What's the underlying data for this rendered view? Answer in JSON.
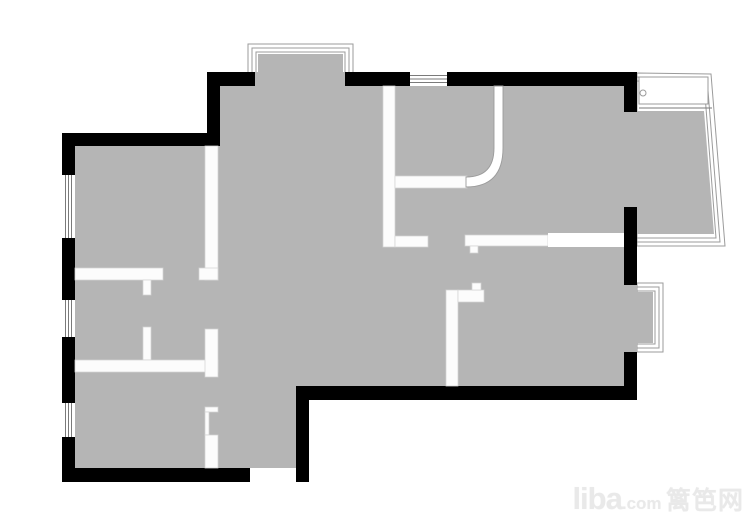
{
  "watermark": {
    "brand": "liba",
    "tld": ".com",
    "site": "篱笆网"
  },
  "colors": {
    "wall": "#000000",
    "floor": "#b5b5b5",
    "outline": "#9b9b9b",
    "partition": "#fcfcfc",
    "background": "#ffffff"
  }
}
